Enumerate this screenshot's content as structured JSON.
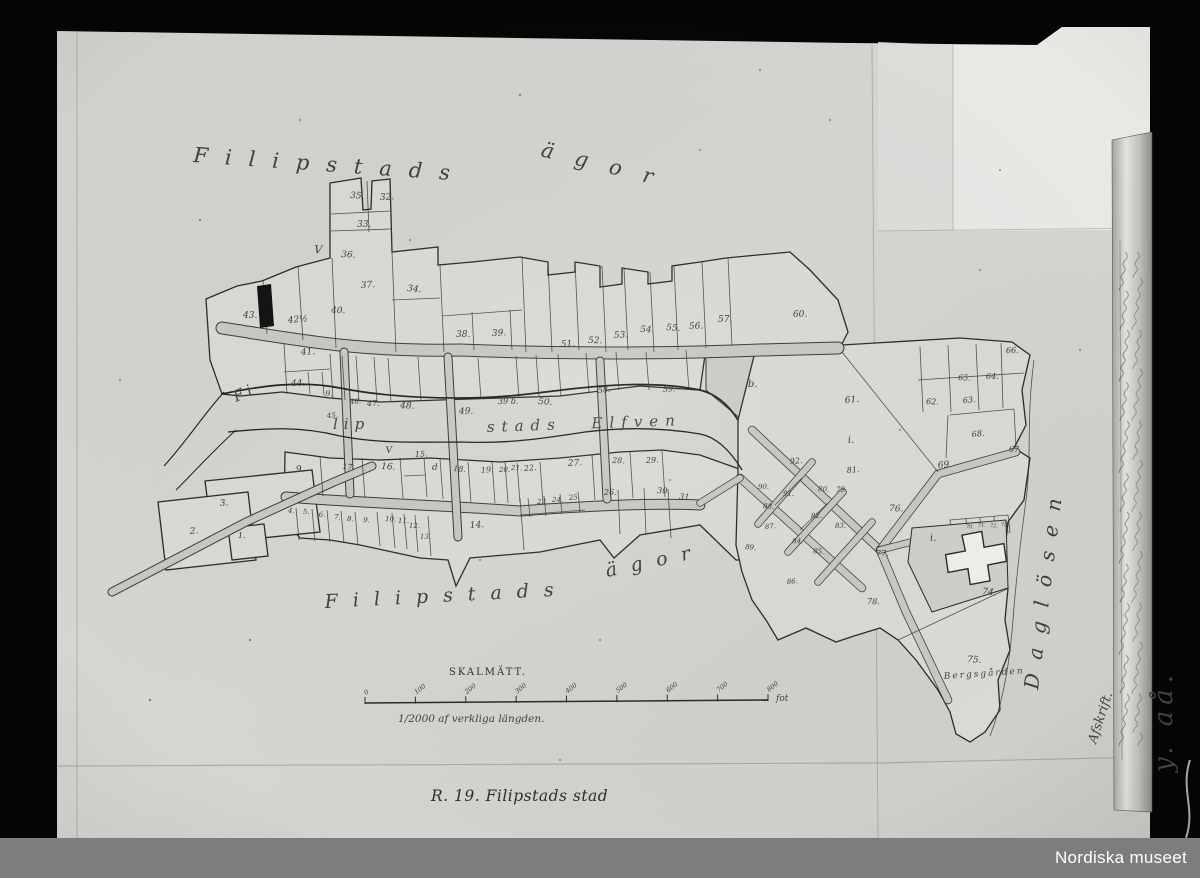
{
  "photo": {
    "archive_label": "Nordiska museet",
    "archive_bar_color": "#7d7d7d",
    "side_inscription": "y. aå.",
    "copy_note": "Afskrift."
  },
  "map": {
    "caption": "R. 19. Filipstads stad",
    "area_label_top": {
      "word1": "Filipstads",
      "word2": "ägor"
    },
    "area_label_bottom": {
      "word1": "Filipstads",
      "word2": "ägor"
    },
    "river_label": {
      "part1": "Fi",
      "part2": "lip",
      "part3": "stads Elfven"
    },
    "lake_label": "Daglösen",
    "district_label": "Bergsgården",
    "scale": {
      "title": "SKALMÄTT.",
      "ticks": [
        "0",
        "100",
        "200",
        "300",
        "400",
        "500",
        "600",
        "700",
        "800"
      ],
      "unit": "fot",
      "note": "1/2000 af verkliga längden."
    },
    "plot_numbers": [
      {
        "t": "43.",
        "x": 243,
        "y": 318
      },
      {
        "t": "42½",
        "x": 288,
        "y": 323
      },
      {
        "t": "40.",
        "x": 331,
        "y": 313
      },
      {
        "t": "37.",
        "x": 361,
        "y": 288
      },
      {
        "t": "35.",
        "x": 350,
        "y": 198
      },
      {
        "t": "32.",
        "x": 380,
        "y": 200
      },
      {
        "t": "33.",
        "x": 357,
        "y": 227
      },
      {
        "t": "36.",
        "x": 341,
        "y": 257
      },
      {
        "t": "34.",
        "x": 407,
        "y": 291
      },
      {
        "t": "38.",
        "x": 456,
        "y": 337
      },
      {
        "t": "39.",
        "x": 492,
        "y": 336
      },
      {
        "t": "V",
        "x": 314,
        "y": 253,
        "s": 11
      },
      {
        "t": "41.",
        "x": 301,
        "y": 355
      },
      {
        "t": "44.",
        "x": 291,
        "y": 386
      },
      {
        "t": "45.",
        "x": 327,
        "y": 418,
        "s": 7
      },
      {
        "t": "9.",
        "x": 325,
        "y": 396,
        "s": 8
      },
      {
        "t": "46.",
        "x": 350,
        "y": 404,
        "s": 7
      },
      {
        "t": "47.",
        "x": 367,
        "y": 406,
        "s": 8
      },
      {
        "t": "48.",
        "x": 400,
        "y": 408
      },
      {
        "t": "49.",
        "x": 459,
        "y": 414
      },
      {
        "t": "39 b.",
        "x": 498,
        "y": 404,
        "s": 8
      },
      {
        "t": "50.",
        "x": 538,
        "y": 404
      },
      {
        "t": "51.",
        "x": 561,
        "y": 347
      },
      {
        "t": "52.",
        "x": 588,
        "y": 343
      },
      {
        "t": "53.",
        "x": 614,
        "y": 338
      },
      {
        "t": "54.",
        "x": 640,
        "y": 332
      },
      {
        "t": "55.",
        "x": 666,
        "y": 330
      },
      {
        "t": "56.",
        "x": 689,
        "y": 329
      },
      {
        "t": "57.",
        "x": 718,
        "y": 322
      },
      {
        "t": "60.",
        "x": 793,
        "y": 317
      },
      {
        "t": "58.",
        "x": 598,
        "y": 393,
        "s": 8
      },
      {
        "t": "59.",
        "x": 663,
        "y": 392,
        "s": 8
      },
      {
        "t": "b.",
        "x": 748,
        "y": 387,
        "s": 10
      },
      {
        "t": "61.",
        "x": 845,
        "y": 403
      },
      {
        "t": "66.",
        "x": 1006,
        "y": 353,
        "s": 8
      },
      {
        "t": "65.",
        "x": 958,
        "y": 380,
        "s": 8
      },
      {
        "t": "64.",
        "x": 986,
        "y": 379,
        "s": 8
      },
      {
        "t": "63.",
        "x": 963,
        "y": 403,
        "s": 8
      },
      {
        "t": "62.",
        "x": 926,
        "y": 404,
        "s": 8
      },
      {
        "t": "68.",
        "x": 972,
        "y": 437,
        "s": 8
      },
      {
        "t": "67.",
        "x": 1009,
        "y": 452,
        "s": 8
      },
      {
        "t": "69.",
        "x": 938,
        "y": 468
      },
      {
        "t": "92.",
        "x": 790,
        "y": 464,
        "s": 8
      },
      {
        "t": "81.",
        "x": 847,
        "y": 473,
        "s": 8
      },
      {
        "t": "90.",
        "x": 758,
        "y": 489,
        "s": 7
      },
      {
        "t": "91.",
        "x": 783,
        "y": 496,
        "s": 7
      },
      {
        "t": "80.",
        "x": 818,
        "y": 491,
        "s": 7
      },
      {
        "t": "79.",
        "x": 836,
        "y": 492,
        "s": 7
      },
      {
        "t": "88.",
        "x": 763,
        "y": 508,
        "s": 7
      },
      {
        "t": "82.",
        "x": 811,
        "y": 518,
        "s": 7
      },
      {
        "t": "83.",
        "x": 835,
        "y": 528,
        "s": 7
      },
      {
        "t": "87.",
        "x": 765,
        "y": 529,
        "s": 7
      },
      {
        "t": "84.",
        "x": 792,
        "y": 543,
        "s": 7
      },
      {
        "t": "85.",
        "x": 813,
        "y": 553,
        "s": 7
      },
      {
        "t": "89.",
        "x": 745,
        "y": 549,
        "s": 7
      },
      {
        "t": "86.",
        "x": 787,
        "y": 584,
        "s": 7
      },
      {
        "t": "76.",
        "x": 889,
        "y": 511,
        "s": 9
      },
      {
        "t": "77.",
        "x": 876,
        "y": 556,
        "s": 8
      },
      {
        "t": "78.",
        "x": 867,
        "y": 604,
        "s": 8
      },
      {
        "t": "70.",
        "x": 966,
        "y": 528,
        "s": 5
      },
      {
        "t": "71.",
        "x": 978,
        "y": 527,
        "s": 5
      },
      {
        "t": "72.",
        "x": 990,
        "y": 527,
        "s": 5
      },
      {
        "t": "73.",
        "x": 1001,
        "y": 526,
        "s": 5
      },
      {
        "t": "74.",
        "x": 982,
        "y": 594
      },
      {
        "t": "75.",
        "x": 967,
        "y": 662
      },
      {
        "t": "i.",
        "x": 848,
        "y": 443,
        "s": 10
      },
      {
        "t": "i.",
        "x": 930,
        "y": 541,
        "s": 10
      },
      {
        "t": "9.",
        "x": 296,
        "y": 472
      },
      {
        "t": "17.",
        "x": 342,
        "y": 469,
        "s": 8
      },
      {
        "t": "16.",
        "x": 381,
        "y": 469
      },
      {
        "t": "V",
        "x": 386,
        "y": 453,
        "s": 9
      },
      {
        "t": "15.",
        "x": 415,
        "y": 457,
        "s": 8
      },
      {
        "t": "d",
        "x": 432,
        "y": 470,
        "s": 9
      },
      {
        "t": "18.",
        "x": 453,
        "y": 471,
        "s": 8
      },
      {
        "t": "19.",
        "x": 481,
        "y": 473,
        "s": 8
      },
      {
        "t": "20.",
        "x": 499,
        "y": 472,
        "s": 7
      },
      {
        "t": "21.",
        "x": 511,
        "y": 470,
        "s": 7
      },
      {
        "t": "22.",
        "x": 524,
        "y": 471,
        "s": 8
      },
      {
        "t": "27.",
        "x": 568,
        "y": 466
      },
      {
        "t": "28.",
        "x": 612,
        "y": 463,
        "s": 8
      },
      {
        "t": "29.",
        "x": 646,
        "y": 463,
        "s": 8
      },
      {
        "t": "4.",
        "x": 288,
        "y": 513,
        "s": 7
      },
      {
        "t": "5.",
        "x": 303,
        "y": 514,
        "s": 7
      },
      {
        "t": "6.",
        "x": 319,
        "y": 517,
        "s": 7
      },
      {
        "t": "7.",
        "x": 334,
        "y": 519,
        "s": 7
      },
      {
        "t": "8.",
        "x": 347,
        "y": 521,
        "s": 7
      },
      {
        "t": "9.",
        "x": 363,
        "y": 522,
        "s": 7
      },
      {
        "t": "10.",
        "x": 385,
        "y": 521,
        "s": 7
      },
      {
        "t": "11.",
        "x": 398,
        "y": 523,
        "s": 7
      },
      {
        "t": "12.",
        "x": 409,
        "y": 528,
        "s": 7
      },
      {
        "t": "13.",
        "x": 420,
        "y": 539,
        "s": 7
      },
      {
        "t": "14.",
        "x": 470,
        "y": 528
      },
      {
        "t": "23.",
        "x": 537,
        "y": 504,
        "s": 7
      },
      {
        "t": "24.",
        "x": 552,
        "y": 502,
        "s": 7
      },
      {
        "t": "25.",
        "x": 569,
        "y": 500,
        "s": 7
      },
      {
        "t": "26.",
        "x": 604,
        "y": 495,
        "s": 8
      },
      {
        "t": "30.",
        "x": 657,
        "y": 493,
        "s": 8
      },
      {
        "t": "31.",
        "x": 679,
        "y": 499,
        "s": 8
      },
      {
        "t": "1.",
        "x": 238,
        "y": 538,
        "s": 8
      },
      {
        "t": "2.",
        "x": 190,
        "y": 534
      },
      {
        "t": "3.",
        "x": 220,
        "y": 506
      }
    ]
  }
}
